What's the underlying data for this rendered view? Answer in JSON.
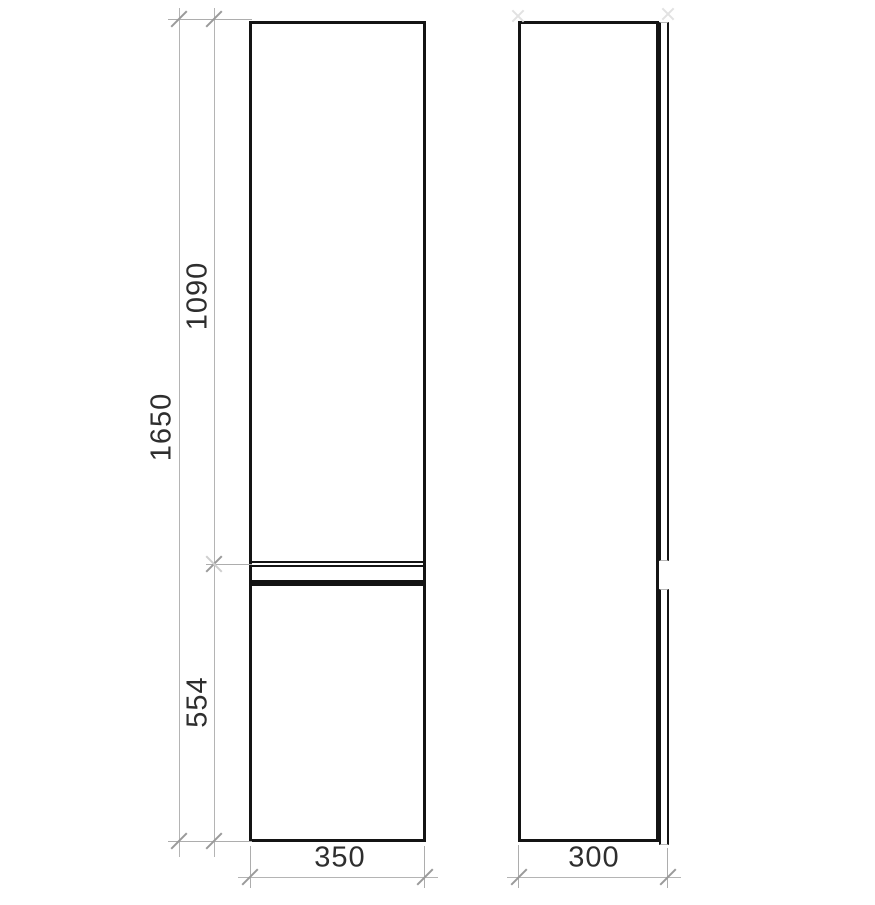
{
  "drawing": {
    "dimensions": {
      "height_total": "1650",
      "upper_section_height": "1090",
      "lower_section_height": "554",
      "front_width": "350",
      "side_depth": "300"
    },
    "colors": {
      "outline": "#141414",
      "dimension_line": "#b4b4b4",
      "tick": "#9a9a9a",
      "text": "#2e2e2e",
      "background": "#ffffff"
    }
  }
}
